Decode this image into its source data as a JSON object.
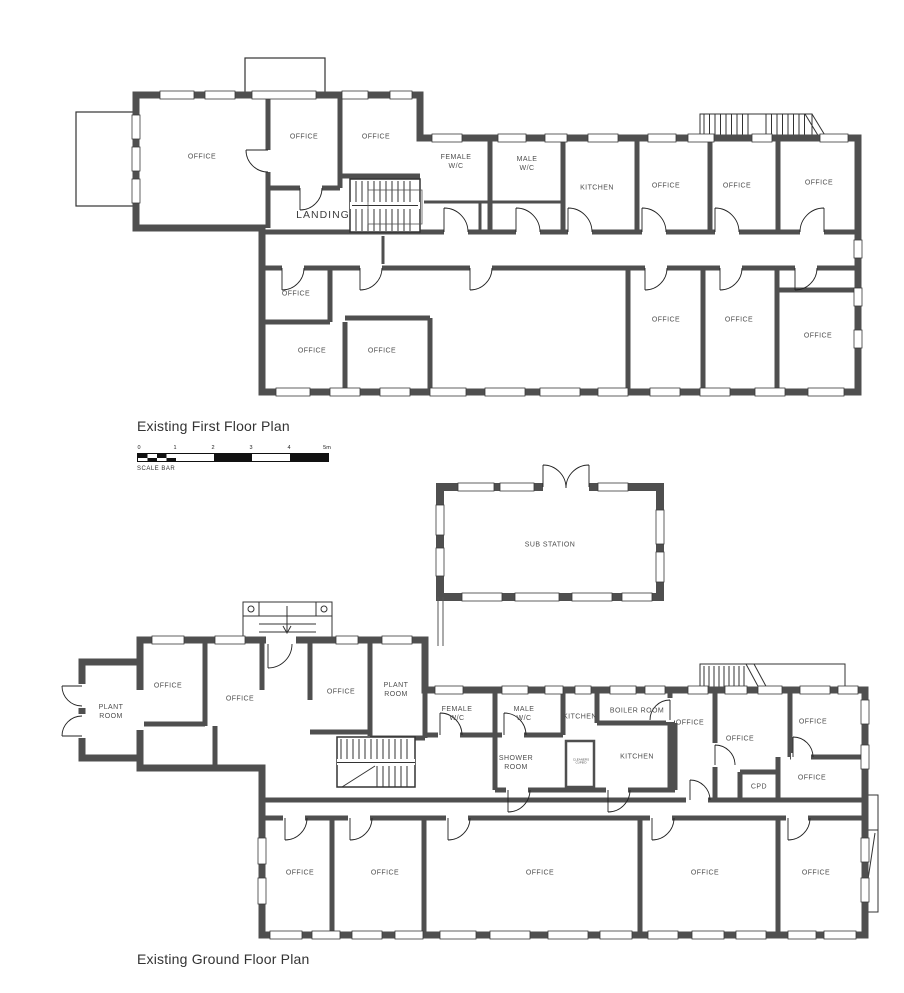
{
  "first_floor": {
    "title": "Existing First Floor Plan",
    "rooms": {
      "office_main": "OFFICE",
      "office_top_a": "OFFICE",
      "office_top_b": "OFFICE",
      "landing": "LANDING",
      "female_wc": "FEMALE\nW/C",
      "male_wc": "MALE\nW/C",
      "kitchen": "KITCHEN",
      "office_top_1": "OFFICE",
      "office_top_2": "OFFICE",
      "office_top_3": "OFFICE",
      "office_mid_left": "OFFICE",
      "office_bottom_left_1": "OFFICE",
      "office_bottom_left_2": "OFFICE",
      "office_bottom_right_1": "OFFICE",
      "office_bottom_right_2": "OFFICE",
      "office_bottom_right_3": "OFFICE"
    }
  },
  "scale_bar": {
    "ticks": [
      "0",
      "1",
      "2",
      "3",
      "4",
      "5m"
    ],
    "label": "SCALE BAR"
  },
  "sub_station": {
    "label": "SUB STATION"
  },
  "ground_floor": {
    "title": "Existing Ground Floor Plan",
    "rooms": {
      "plant_room_west": "PLANT\nROOM",
      "office_nw_1": "OFFICE",
      "office_nw_2": "OFFICE",
      "office_nw_3": "OFFICE",
      "plant_room_2": "PLANT\nROOM",
      "female_wc": "FEMALE\nW/C",
      "male_wc": "MALE\nW/C",
      "kitchen_small": "KITCHEN",
      "boiler_room": "BOILER ROOM",
      "office_ne_1": "OFFICE",
      "office_ne_2": "OFFICE",
      "office_ne_3": "OFFICE",
      "office_ne_4": "OFFICE",
      "shower_room": "SHOWER\nROOM",
      "cleaners_cupboard": "CLEANERS\nCUPB'D",
      "kitchen_main": "KITCHEN",
      "cpd": "CPD",
      "office_s_1": "OFFICE",
      "office_s_2": "OFFICE",
      "office_s_3": "OFFICE",
      "office_s_4": "OFFICE",
      "office_s_5": "OFFICE"
    }
  }
}
